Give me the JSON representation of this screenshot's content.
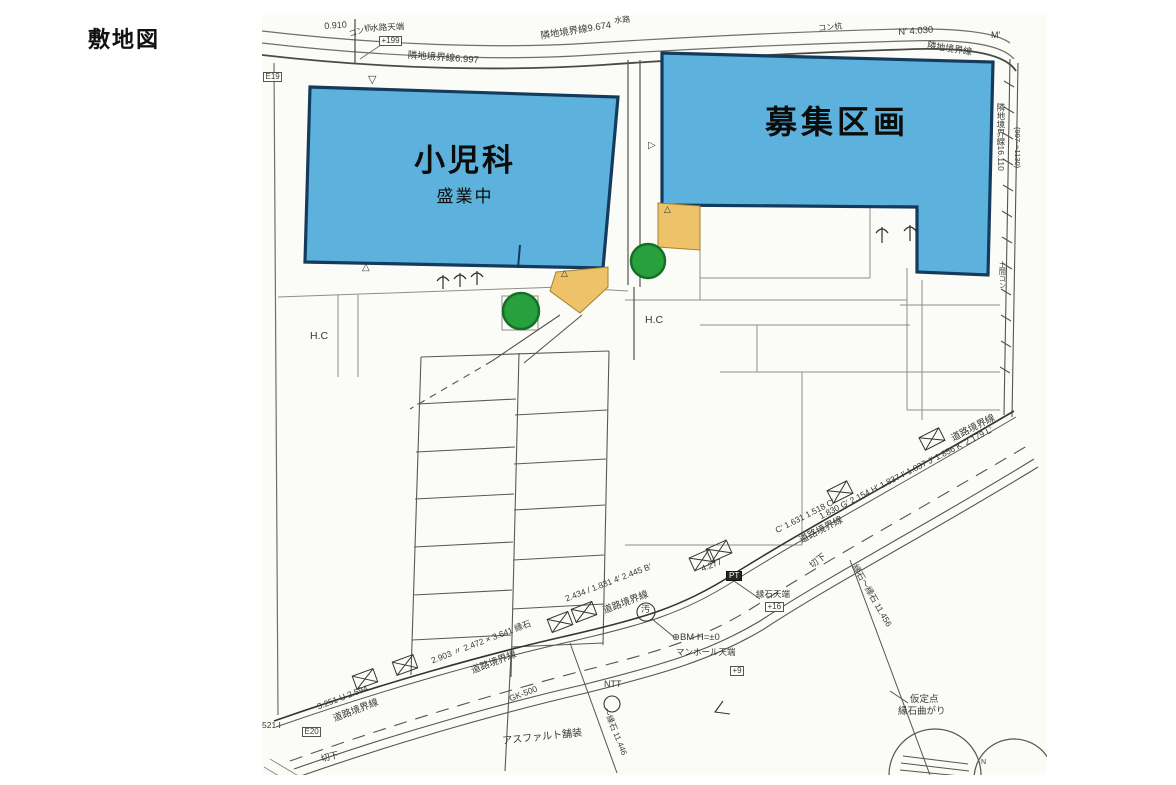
{
  "site_title": "敷地図",
  "buildings": {
    "pediatrics": {
      "name": "小児科",
      "status": "盛業中"
    },
    "vacant": {
      "name": "募集区画"
    }
  },
  "colors": {
    "paper": "#fbfbf8",
    "highlight-blue": "#5db2dd",
    "highlight-blue-border": "#143a5c",
    "highlight-orange": "#eec269",
    "highlight-orange-border": "#a1812c",
    "highlight-green": "#28a03d",
    "highlight-green-border": "#166f26",
    "ink": "#35352f",
    "line": "#8e8e89"
  },
  "annotations": [
    {
      "n": "dim-0910",
      "t": "0.910",
      "x": 62,
      "y": 7,
      "r": -4,
      "s": 9
    },
    {
      "n": "label-kon-kui-left",
      "t": "コン杭",
      "x": 86,
      "y": 16,
      "r": -18,
      "s": 8
    },
    {
      "n": "label-suiro-tenba",
      "t": "水路天端",
      "x": 108,
      "y": 9,
      "r": -3,
      "s": 8.5
    },
    {
      "n": "label-suiro-tenba-value",
      "t": "+199",
      "x": 117,
      "y": 21,
      "r": 0,
      "s": 8,
      "c": "box"
    },
    {
      "n": "label-rinchi-6997",
      "t": "隣地境界線6.997",
      "x": 146,
      "y": 36,
      "r": 4,
      "s": 9.5
    },
    {
      "n": "label-rinchi-9674",
      "t": "隣地境界線9.674",
      "x": 278,
      "y": 17,
      "r": -9,
      "s": 9.5
    },
    {
      "n": "label-suiro",
      "t": "水路",
      "x": 352,
      "y": 2,
      "r": -4,
      "s": 8
    },
    {
      "n": "label-kon-kui-right",
      "t": "コン杭",
      "x": 556,
      "y": 10,
      "r": -6,
      "s": 8
    },
    {
      "n": "dim-n-4030",
      "t": "N′ 4.030",
      "x": 636,
      "y": 13,
      "r": -4,
      "s": 9.5
    },
    {
      "n": "label-m-prime",
      "t": "M′",
      "x": 729,
      "y": 16,
      "r": 0,
      "s": 9
    },
    {
      "n": "label-rinchi-topright",
      "t": "隣地境界線",
      "x": 666,
      "y": 26,
      "r": 9,
      "s": 9
    },
    {
      "n": "label-e19",
      "t": "E19",
      "x": 1,
      "y": 57,
      "r": 0,
      "s": 8,
      "c": "box"
    },
    {
      "n": "label-rinchi-16110",
      "t": "隣地境界線16.110",
      "x": 734,
      "y": 88,
      "r": 0,
      "s": 8.5,
      "c": "v"
    },
    {
      "n": "label-997-1130",
      "t": "(997〜1130)",
      "x": 751,
      "y": 112,
      "r": 0,
      "s": 7.5,
      "c": "v"
    },
    {
      "n": "label-doma-kon",
      "t": "土間コン",
      "x": 736,
      "y": 246,
      "r": 0,
      "s": 7,
      "c": "v"
    },
    {
      "n": "label-hc-left",
      "t": "H.C",
      "x": 48,
      "y": 316,
      "r": 0,
      "s": 10.5
    },
    {
      "n": "label-hc-right",
      "t": "H.C",
      "x": 383,
      "y": 300,
      "r": 0,
      "s": 10.5
    },
    {
      "n": "marker-nabla-top",
      "t": "▽",
      "x": 106,
      "y": 60,
      "r": 0,
      "s": 11
    },
    {
      "n": "marker-triangle-left",
      "t": "△",
      "x": 100,
      "y": 248,
      "r": 0,
      "s": 10
    },
    {
      "n": "marker-triangle-orange-left",
      "t": "△",
      "x": 299,
      "y": 254,
      "r": 0,
      "s": 9
    },
    {
      "n": "marker-triangle-orange-mid",
      "t": "△",
      "x": 402,
      "y": 190,
      "r": 0,
      "s": 9
    },
    {
      "n": "marker-triangle-side",
      "t": "▷",
      "x": 386,
      "y": 126,
      "r": 0,
      "s": 10
    },
    {
      "n": "road-dim-1",
      "t": "3.251 U 2.594",
      "x": 54,
      "y": 688,
      "r": -21,
      "s": 8.5
    },
    {
      "n": "road-label-1",
      "t": "道路境界線",
      "x": 70,
      "y": 700,
      "r": -21,
      "s": 9.5
    },
    {
      "n": "label-e20",
      "t": "E20",
      "x": 40,
      "y": 712,
      "r": 0,
      "s": 8,
      "c": "box"
    },
    {
      "n": "label-521",
      "t": "521 I",
      "x": 0,
      "y": 706,
      "r": 0,
      "s": 8.5
    },
    {
      "n": "label-kirisage-left",
      "t": "切下",
      "x": 58,
      "y": 740,
      "r": -14,
      "s": 9
    },
    {
      "n": "road-dim-2",
      "t": "2.903 〃 2.472 × 3.641 縁石",
      "x": 168,
      "y": 642,
      "r": -21,
      "s": 8.5
    },
    {
      "n": "road-label-2",
      "t": "道路境界線",
      "x": 208,
      "y": 652,
      "r": -21,
      "s": 9.5
    },
    {
      "n": "label-gk500",
      "t": "GK-500",
      "x": 246,
      "y": 680,
      "r": -21,
      "s": 8.5
    },
    {
      "n": "label-asphalt",
      "t": "アスファルト舗装",
      "x": 240,
      "y": 722,
      "r": -6,
      "s": 10
    },
    {
      "n": "road-dim-3",
      "t": "2.434 / 1.831 4′ 2.445 B′",
      "x": 302,
      "y": 580,
      "r": -21,
      "s": 8.5
    },
    {
      "n": "road-label-3",
      "t": "道路境界線",
      "x": 340,
      "y": 592,
      "r": -21,
      "s": 9.5
    },
    {
      "n": "road-dim-4277",
      "t": "4.277",
      "x": 438,
      "y": 550,
      "r": -21,
      "s": 8.5
    },
    {
      "n": "label-pt",
      "t": "PT",
      "x": 464,
      "y": 556,
      "r": 0,
      "s": 8,
      "c": "bb"
    },
    {
      "n": "label-enseki-tenba",
      "t": "縁石天端",
      "x": 494,
      "y": 575,
      "r": 0,
      "s": 8.5
    },
    {
      "n": "label-enseki-value",
      "t": "+16",
      "x": 503,
      "y": 587,
      "r": 0,
      "s": 8,
      "c": "box"
    },
    {
      "n": "label-osui",
      "t": "汚",
      "x": 379,
      "y": 590,
      "r": 0,
      "s": 9
    },
    {
      "n": "label-bm",
      "t": "⊕BM H=±0",
      "x": 410,
      "y": 618,
      "r": 0,
      "s": 9.5
    },
    {
      "n": "label-manhole-tenba",
      "t": "マンホール天端",
      "x": 414,
      "y": 633,
      "r": 0,
      "s": 8.5
    },
    {
      "n": "label-plus9",
      "t": "+9",
      "x": 468,
      "y": 651,
      "r": 0,
      "s": 8,
      "c": "box"
    },
    {
      "n": "label-ntt",
      "t": "NTT",
      "x": 342,
      "y": 665,
      "r": 0,
      "s": 9
    },
    {
      "n": "dim-11446",
      "t": "〜縁石 11.446",
      "x": 347,
      "y": 692,
      "r": 68,
      "s": 8
    },
    {
      "n": "label-kirisage-right",
      "t": "切下",
      "x": 546,
      "y": 548,
      "r": -38,
      "s": 9
    },
    {
      "n": "road-dim-4",
      "t": "C′ 1.631 1.518 C′",
      "x": 512,
      "y": 512,
      "r": -27,
      "s": 8.5
    },
    {
      "n": "road-label-4",
      "t": "道路境界線",
      "x": 536,
      "y": 522,
      "r": -27,
      "s": 9.5
    },
    {
      "n": "road-dim-5",
      "t": "1.830 G′ 2.154 H′ 1.837 I′ 1.837 J′ 1.856 K′ 2.179 L′",
      "x": 556,
      "y": 498,
      "r": -27,
      "s": 8.5
    },
    {
      "n": "road-label-5",
      "t": "道路境界線",
      "x": 688,
      "y": 420,
      "r": -27,
      "s": 9.5
    },
    {
      "n": "dim-11456",
      "t": "縁石〜縁石 11.456",
      "x": 596,
      "y": 548,
      "r": 60,
      "s": 8.5
    },
    {
      "n": "label-katei-ten",
      "t": "仮定点",
      "x": 648,
      "y": 680,
      "r": 0,
      "s": 9.5
    },
    {
      "n": "label-enseki-magari",
      "t": "縁石曲がり",
      "x": 636,
      "y": 692,
      "r": 0,
      "s": 9.5
    },
    {
      "n": "label-n-small",
      "t": "N",
      "x": 719,
      "y": 744,
      "r": 0,
      "s": 7
    }
  ]
}
